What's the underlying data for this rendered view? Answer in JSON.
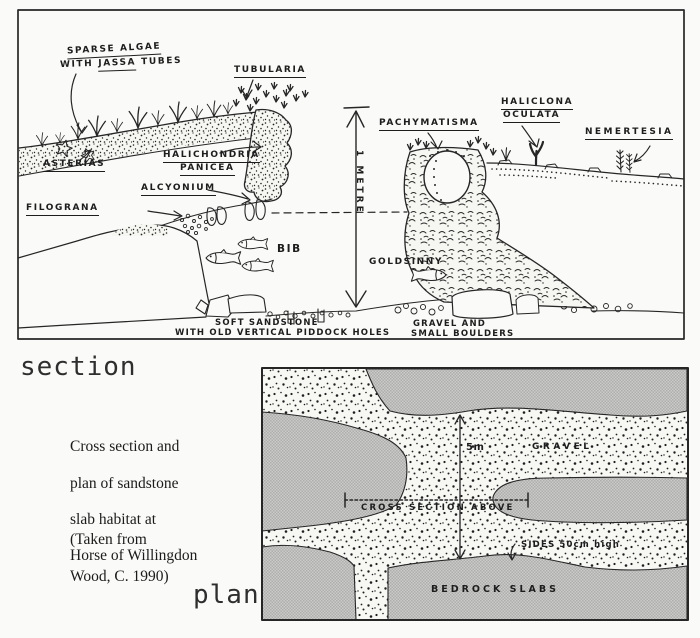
{
  "colors": {
    "ink": "#262626",
    "paper": "#fafaf8",
    "halftone_grey": "#c4c4c2"
  },
  "section": {
    "heading": "section",
    "scale_label": "1 METRE",
    "species_labels": {
      "sparse_algae_line1": "SPARSE ALGAE",
      "sparse_algae_line2": [
        "WITH",
        "JASSA",
        "TUBES"
      ],
      "tubularia": "TUBULARIA",
      "asterias": "ASTERIAS",
      "halichondria": [
        "HALICHONDRIA",
        "PANICEA"
      ],
      "alcyonium": "ALCYONIUM",
      "filograna": "FILOGRANA",
      "pachymatisma": "PACHYMATISMA",
      "haliclona": [
        "HALICLONA",
        "OCULATA"
      ],
      "nemertesia": "NEMERTESIA"
    },
    "fish_labels": {
      "bib": "BIB",
      "goldsinny": "GOLDSINNY"
    },
    "substrate_labels": {
      "soft_sandstone": [
        "SOFT SANDSTONE",
        "WITH OLD VERTICAL PIDDOCK HOLES"
      ],
      "gravel": [
        "GRAVEL AND",
        "SMALL BOULDERS"
      ]
    }
  },
  "plan": {
    "heading": "plan",
    "scale_label": "5m",
    "labels": {
      "gravel": "GRAVEL",
      "cross_section": "CROSS SECTION ABOVE",
      "sides": "SIDES 50cm high",
      "bedrock": "BEDROCK SLABS"
    }
  },
  "caption": {
    "lines": [
      "Cross section and",
      "plan of sandstone",
      "slab habitat at",
      "Horse of Willingdon"
    ],
    "source": [
      "(Taken from",
      "Wood, C. 1990)"
    ]
  }
}
